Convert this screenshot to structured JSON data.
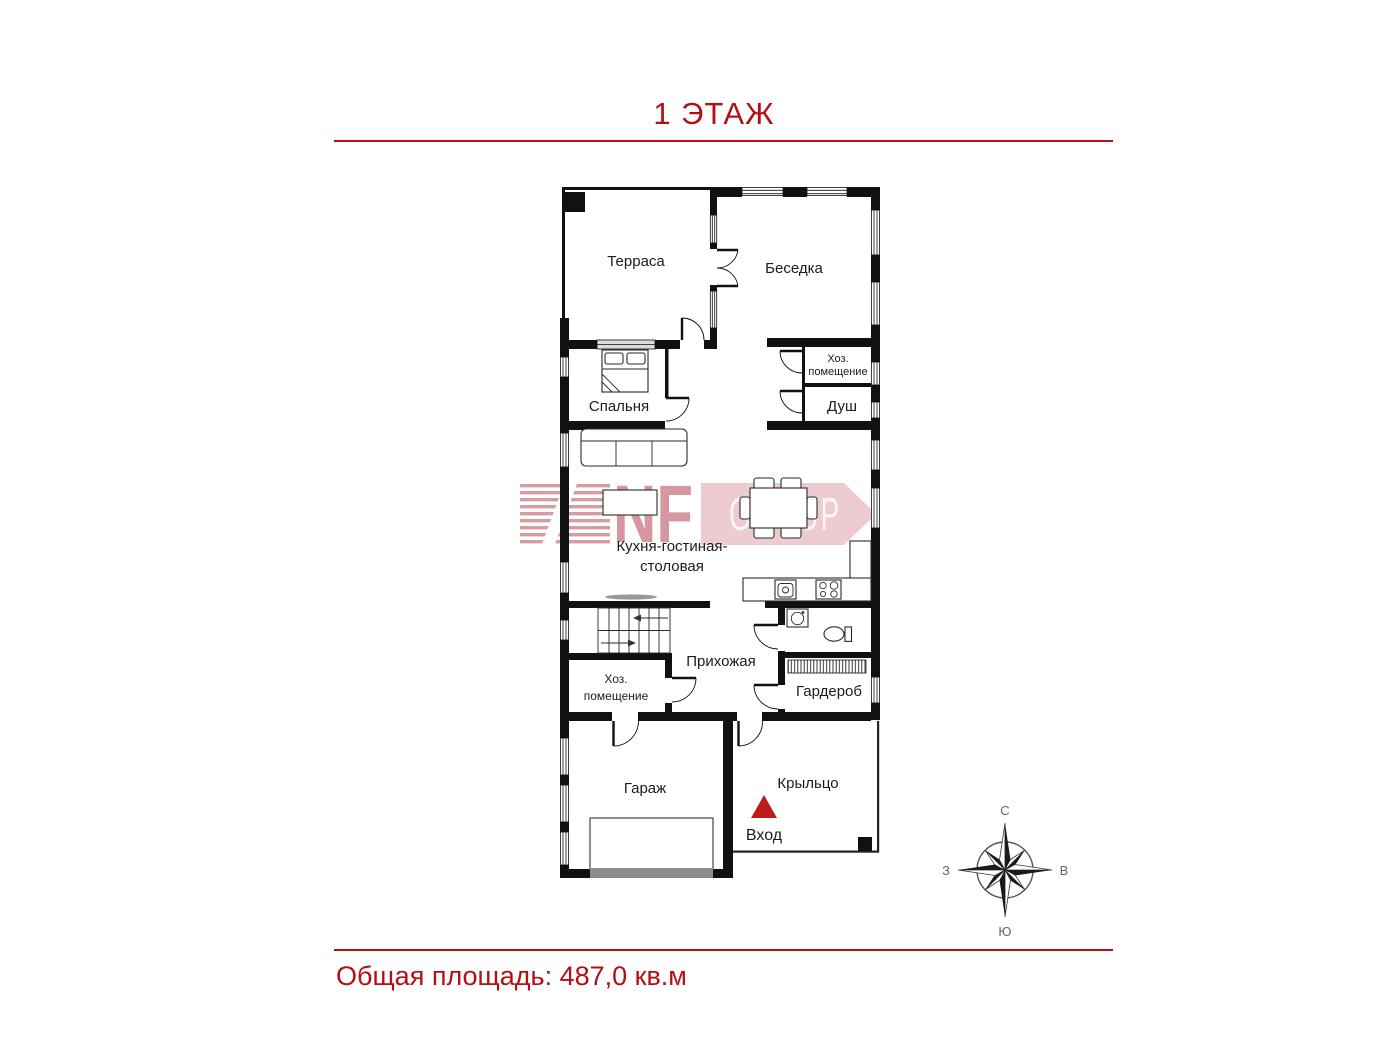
{
  "title": "1 ЭТАЖ",
  "footer": {
    "total_area": "Общая площадь: 487,0 кв.м"
  },
  "watermark": {
    "nf": "NF",
    "group": "GROUP"
  },
  "compass": {
    "north": "С",
    "east": "В",
    "south": "Ю",
    "west": "З"
  },
  "colors": {
    "accent_red": "#b30f15",
    "entrance_red": "#bb1e18",
    "wall_black": "#111111",
    "watermark_pink": "#cf8790",
    "watermark_light_pink": "#e9c4c8",
    "garage_door_gray": "#8c8c8c"
  },
  "floor_plan": {
    "rooms": {
      "terrace": "Терраса",
      "gazebo": "Беседка",
      "bedroom": "Спальня",
      "utility_top_line1": "Хоз.",
      "utility_top_line2": "помещение",
      "shower": "Душ",
      "kitchen_living_line1": "Кухня-гостиная-",
      "kitchen_living_line2": "столовая",
      "hallway": "Прихожая",
      "utility_bottom_line1": "Хоз.",
      "utility_bottom_line2": "помещение",
      "wardrobe": "Гардероб",
      "garage": "Гараж",
      "porch": "Крыльцо"
    },
    "entrance_label": "Вход"
  }
}
